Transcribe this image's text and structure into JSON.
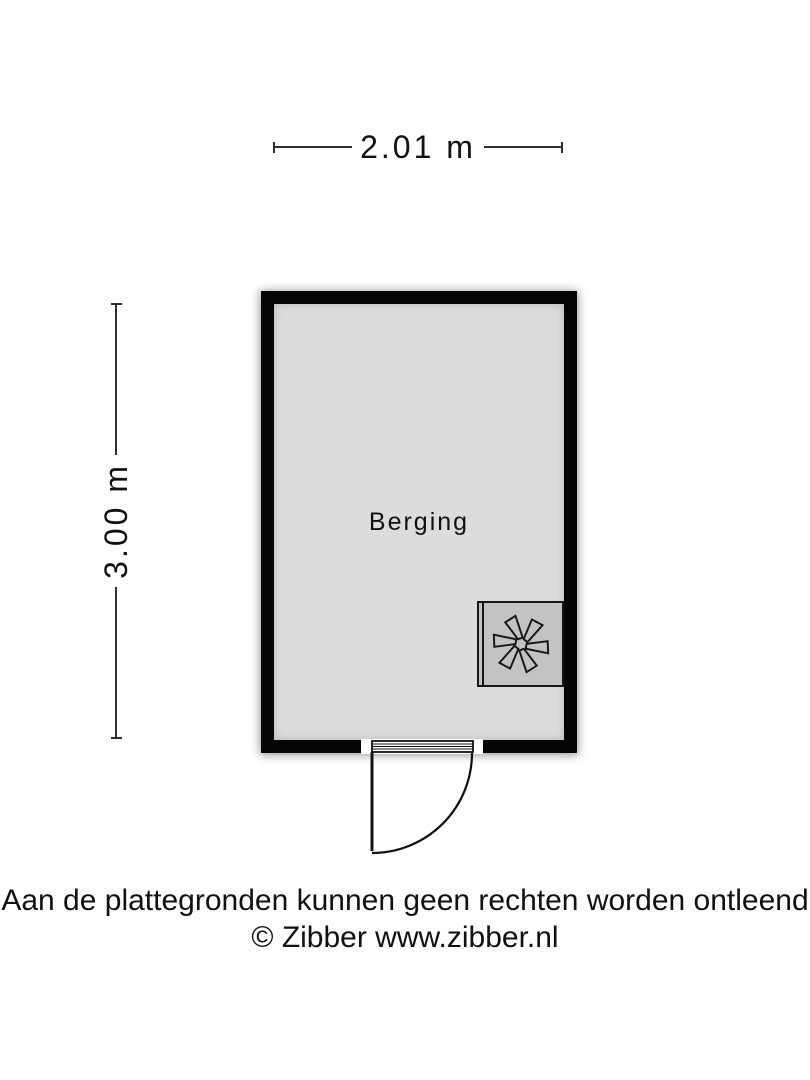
{
  "dimensions": {
    "width_label": "2.01 m",
    "height_label": "3.00 m"
  },
  "room": {
    "label": "Berging"
  },
  "icons": {
    "ventilation_fan_icon": "✻"
  },
  "footer": {
    "disclaimer": "Aan de plattegronden kunnen geen rechten worden ontleend",
    "copyright": "© Zibber www.zibber.nl"
  },
  "colors": {
    "background": "#ffffff",
    "wall": "#050505",
    "floor": "#dcdcdc",
    "fan_box": "#c3c3c3",
    "line": "#2f2f2f",
    "text": "#111111"
  }
}
